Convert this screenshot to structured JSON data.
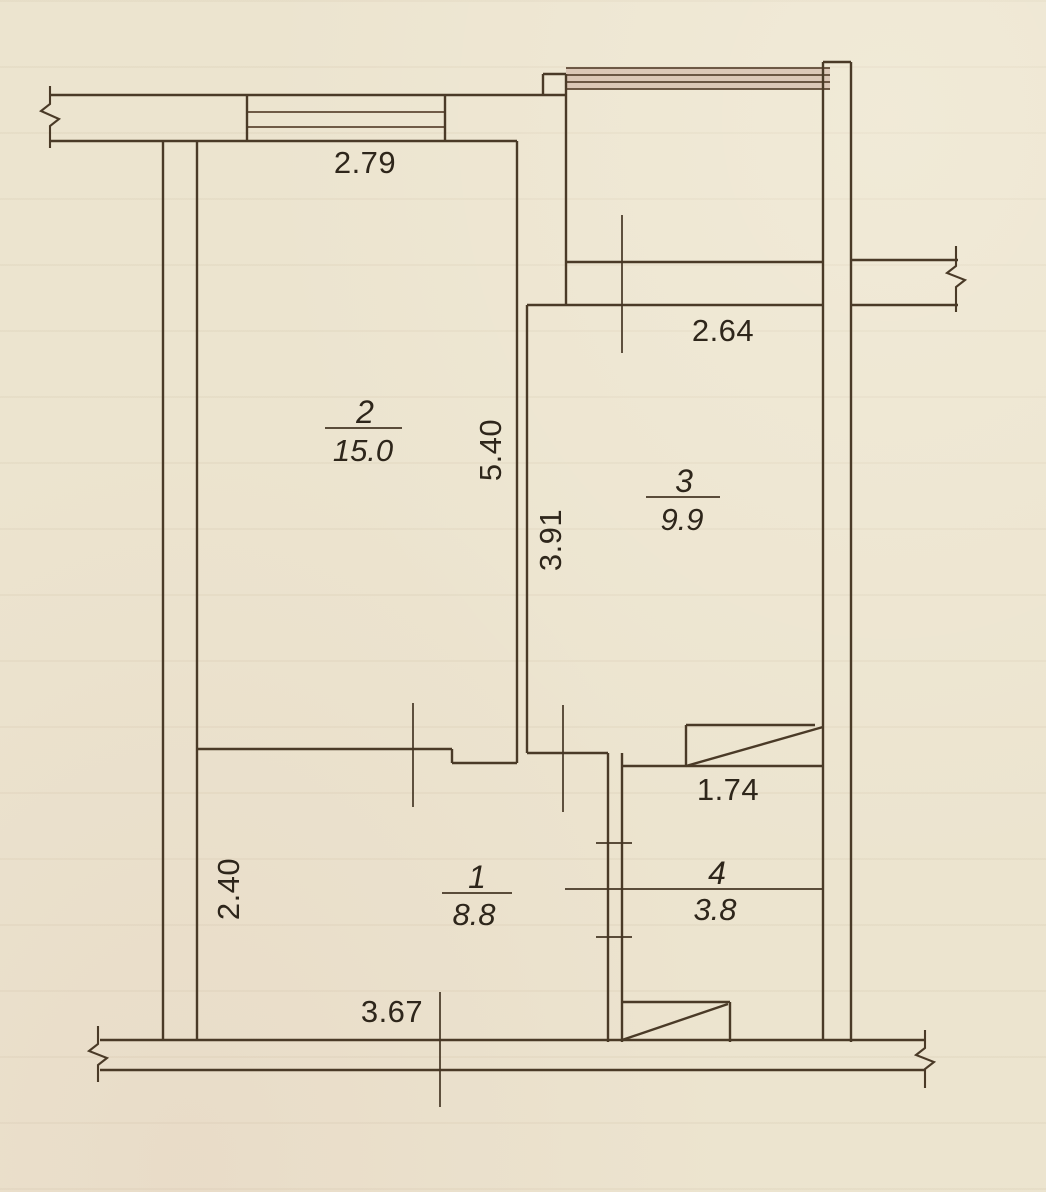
{
  "drawing": {
    "type": "floor-plan",
    "units": "m",
    "paper_color": "#ece4cf",
    "line_color": "#4a3a27",
    "text_color": "#2e261b",
    "window_tint": "rgba(177,126,117,0.30)"
  },
  "rooms": [
    {
      "number": "2",
      "area": "15.0",
      "num_x": 365,
      "num_y": 423,
      "area_x": 363,
      "area_y": 461
    },
    {
      "number": "3",
      "area": "9.9",
      "num_x": 684,
      "num_y": 492,
      "area_x": 682,
      "area_y": 530
    },
    {
      "number": "1",
      "area": "8.8",
      "num_x": 477,
      "num_y": 888,
      "area_x": 474,
      "area_y": 925
    },
    {
      "number": "4",
      "area": "3.8",
      "num_x": 717,
      "num_y": 884,
      "area_x": 715,
      "area_y": 920
    }
  ],
  "dimensions": [
    {
      "value": "2.79",
      "x": 365,
      "y": 173,
      "rotate": 0
    },
    {
      "value": "2.64",
      "x": 723,
      "y": 341,
      "rotate": 0
    },
    {
      "value": "5.40",
      "x": 490,
      "y": 450,
      "rotate": -90
    },
    {
      "value": "3.91",
      "x": 550,
      "y": 540,
      "rotate": -90
    },
    {
      "value": "1.74",
      "x": 728,
      "y": 800,
      "rotate": 0
    },
    {
      "value": "2.40",
      "x": 228,
      "y": 889,
      "rotate": -90
    },
    {
      "value": "3.67",
      "x": 392,
      "y": 1022,
      "rotate": 0
    }
  ],
  "plan": {
    "walls": [
      [
        50,
        95,
        567,
        95
      ],
      [
        50,
        141,
        517,
        141
      ],
      [
        247,
        95,
        247,
        141
      ],
      [
        445,
        95,
        445,
        141
      ],
      [
        163,
        141,
        163,
        1040
      ],
      [
        197,
        141,
        197,
        1040
      ],
      [
        517,
        141,
        517,
        763
      ],
      [
        527,
        305,
        527,
        753
      ],
      [
        543,
        74,
        566,
        74
      ],
      [
        543,
        74,
        543,
        95
      ],
      [
        566,
        74,
        566,
        305
      ],
      [
        823,
        62,
        851,
        62
      ],
      [
        823,
        62,
        823,
        1040
      ],
      [
        851,
        62,
        851,
        1042
      ],
      [
        566,
        262,
        823,
        262
      ],
      [
        527,
        305,
        823,
        305
      ],
      [
        851,
        260,
        958,
        260
      ],
      [
        851,
        305,
        958,
        305
      ],
      [
        197,
        749,
        452,
        749
      ],
      [
        452,
        749,
        452,
        763
      ],
      [
        452,
        763,
        517,
        763
      ],
      [
        527,
        753,
        608,
        753
      ],
      [
        608,
        753,
        608,
        1042
      ],
      [
        622,
        753,
        622,
        1042
      ],
      [
        622,
        766,
        823,
        766
      ],
      [
        686,
        725,
        815,
        725
      ],
      [
        686,
        725,
        686,
        766
      ],
      [
        686,
        766,
        823,
        727
      ],
      [
        622,
        1002,
        730,
        1002
      ],
      [
        730,
        1002,
        730,
        1042
      ],
      [
        622,
        1040,
        728,
        1004
      ],
      [
        100,
        1040,
        925,
        1040
      ],
      [
        100,
        1070,
        925,
        1070
      ]
    ],
    "glazing": [
      [
        247,
        112,
        445,
        112
      ],
      [
        247,
        127,
        445,
        127
      ],
      [
        566,
        68,
        830,
        68
      ],
      [
        566,
        75,
        830,
        75
      ],
      [
        566,
        82,
        830,
        82
      ],
      [
        566,
        89,
        830,
        89
      ]
    ],
    "thin_lines": [
      [
        413,
        703,
        413,
        807
      ],
      [
        563,
        705,
        563,
        812
      ],
      [
        622,
        215,
        622,
        353
      ],
      [
        440,
        992,
        440,
        1107
      ],
      [
        565,
        889,
        823,
        889
      ],
      [
        325,
        428,
        402,
        428
      ],
      [
        646,
        497,
        720,
        497
      ],
      [
        442,
        893,
        512,
        893
      ],
      [
        596,
        843,
        632,
        843
      ],
      [
        596,
        937,
        632,
        937
      ]
    ],
    "break_marks": [
      [
        [
          50,
          86
        ],
        [
          50,
          104
        ],
        [
          41,
          111
        ],
        [
          59,
          119
        ],
        [
          50,
          126
        ],
        [
          50,
          148
        ]
      ],
      [
        [
          98,
          1026
        ],
        [
          98,
          1044
        ],
        [
          89,
          1051
        ],
        [
          107,
          1058
        ],
        [
          98,
          1065
        ],
        [
          98,
          1082
        ]
      ],
      [
        [
          925,
          1030
        ],
        [
          925,
          1048
        ],
        [
          916,
          1055
        ],
        [
          934,
          1062
        ],
        [
          925,
          1069
        ],
        [
          925,
          1088
        ]
      ],
      [
        [
          956,
          246
        ],
        [
          956,
          266
        ],
        [
          947,
          273
        ],
        [
          965,
          280
        ],
        [
          956,
          287
        ],
        [
          956,
          312
        ]
      ]
    ],
    "window_tint_rect": {
      "x": 566,
      "y": 68,
      "w": 264,
      "h": 21
    }
  }
}
